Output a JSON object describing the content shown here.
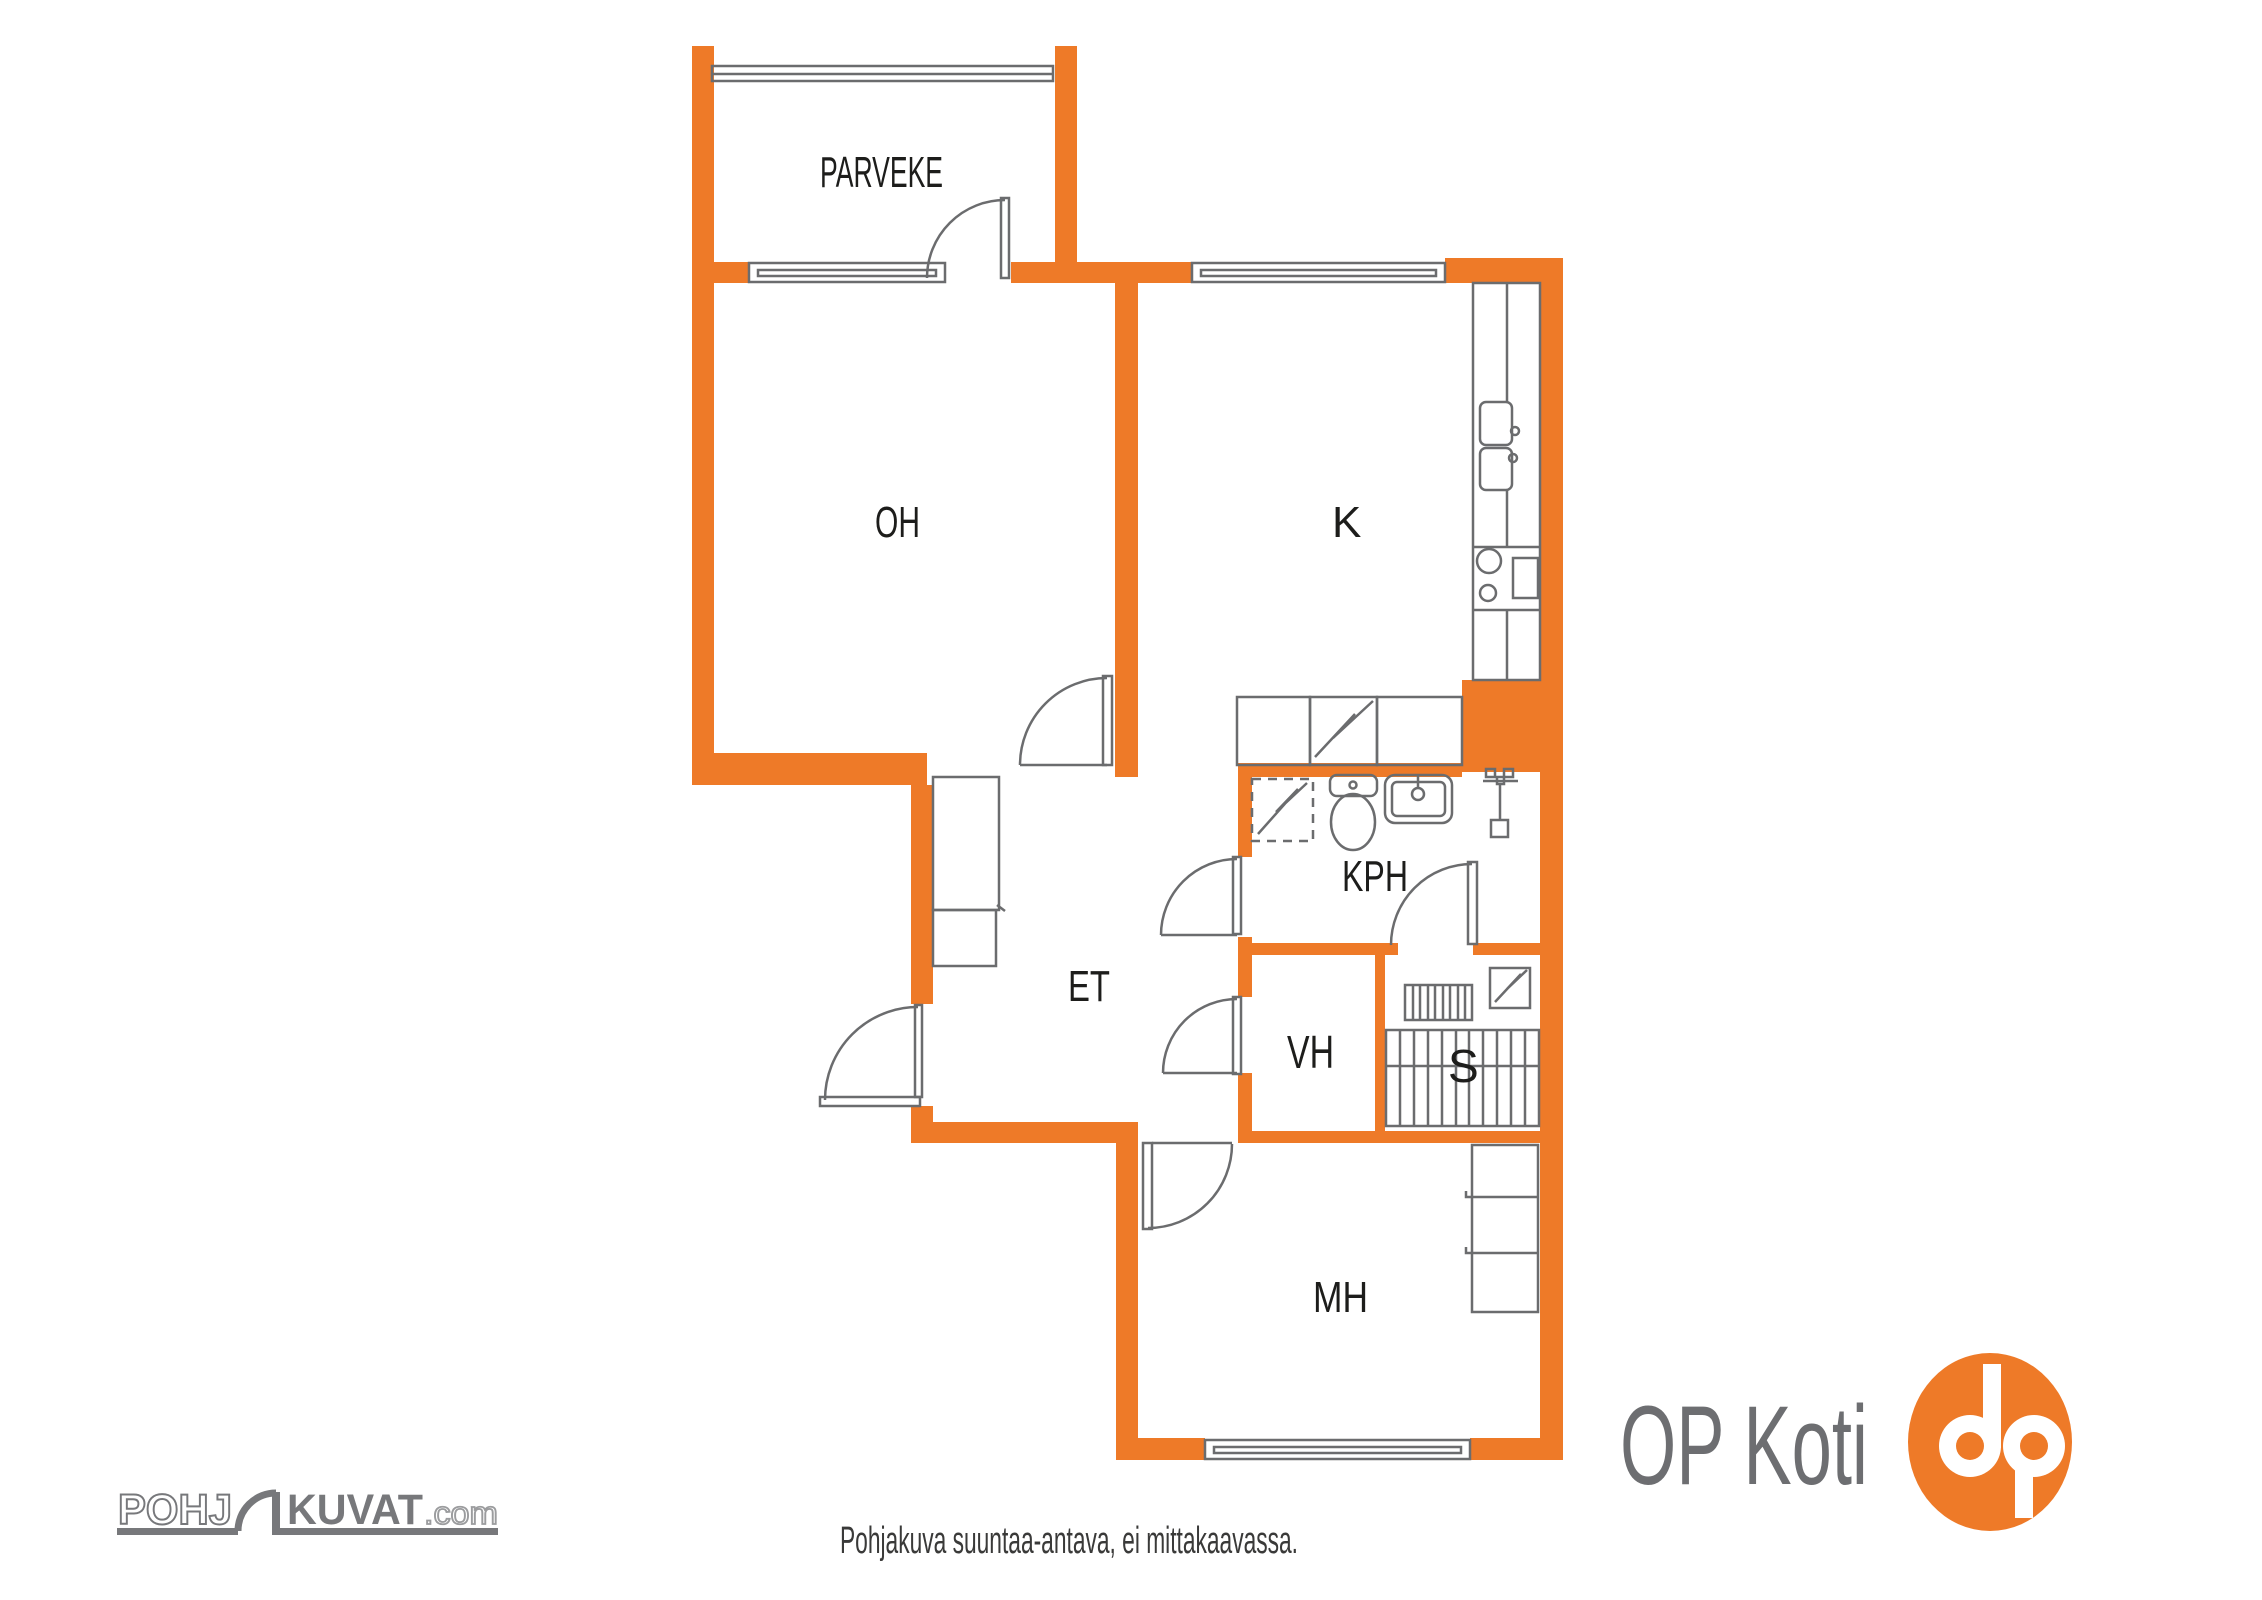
{
  "colors": {
    "orange": "#EE7A28",
    "line": "#6b6c6e",
    "label": "#1d1d1b",
    "disclaimer_text": "#3a3a39",
    "logo_gray": "#6d6e71",
    "logo_outline": "#77787b"
  },
  "rooms": {
    "parveke": "PARVEKE",
    "oh": "OH",
    "k": "K",
    "kph": "KPH",
    "et": "ET",
    "vh": "VH",
    "s": "S",
    "mh": "MH"
  },
  "footer": {
    "disclaimer": "Pohjakuva suuntaa-antava, ei mittakaavassa."
  },
  "logos": {
    "pohjakuvat": {
      "part1": "POHJ",
      "part2": "KUVAT",
      "part3": ".com"
    },
    "op_koti": "OP Koti"
  }
}
